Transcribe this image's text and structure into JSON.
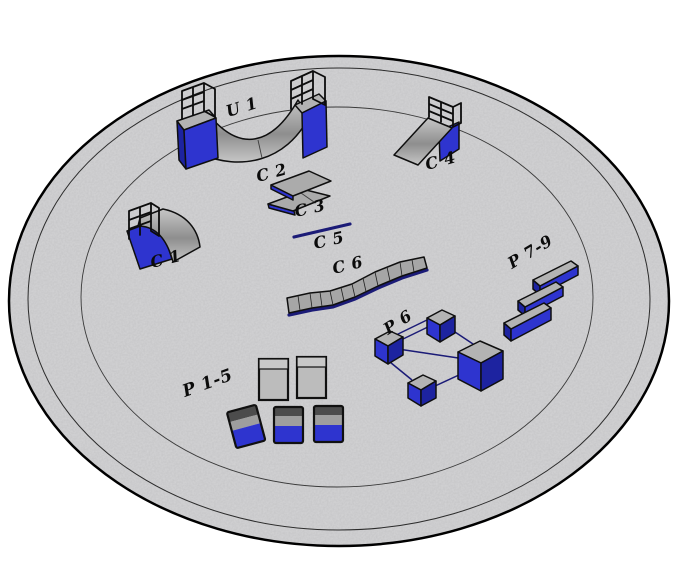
{
  "palette": {
    "ground": "#d4d4d6",
    "blue": "#2e34cf",
    "blue_dark": "#1d23a0",
    "platform_gray": "#b3b3b3",
    "box_gray": "#bcbcbc",
    "band_dark": "#4c4c4c",
    "band_mid": "#9e9e9e",
    "ramp_gray_dark": "#8e8e8e",
    "ramp_gray_light": "#c6c6c6",
    "rail_blue": "#1b1b77",
    "outline": "#0c0c0c"
  },
  "obstacles": {
    "u1": {
      "label": "U 1"
    },
    "c1": {
      "label": "C 1"
    },
    "c2": {
      "label": "C 2"
    },
    "c3": {
      "label": "C 3"
    },
    "c4": {
      "label": "C 4"
    },
    "c5": {
      "label": "C 5"
    },
    "c6": {
      "label": "C 6"
    },
    "p1_5": {
      "label": "P 1-5"
    },
    "p6": {
      "label": "P 6"
    },
    "p7_9": {
      "label": "P 7-9"
    }
  }
}
